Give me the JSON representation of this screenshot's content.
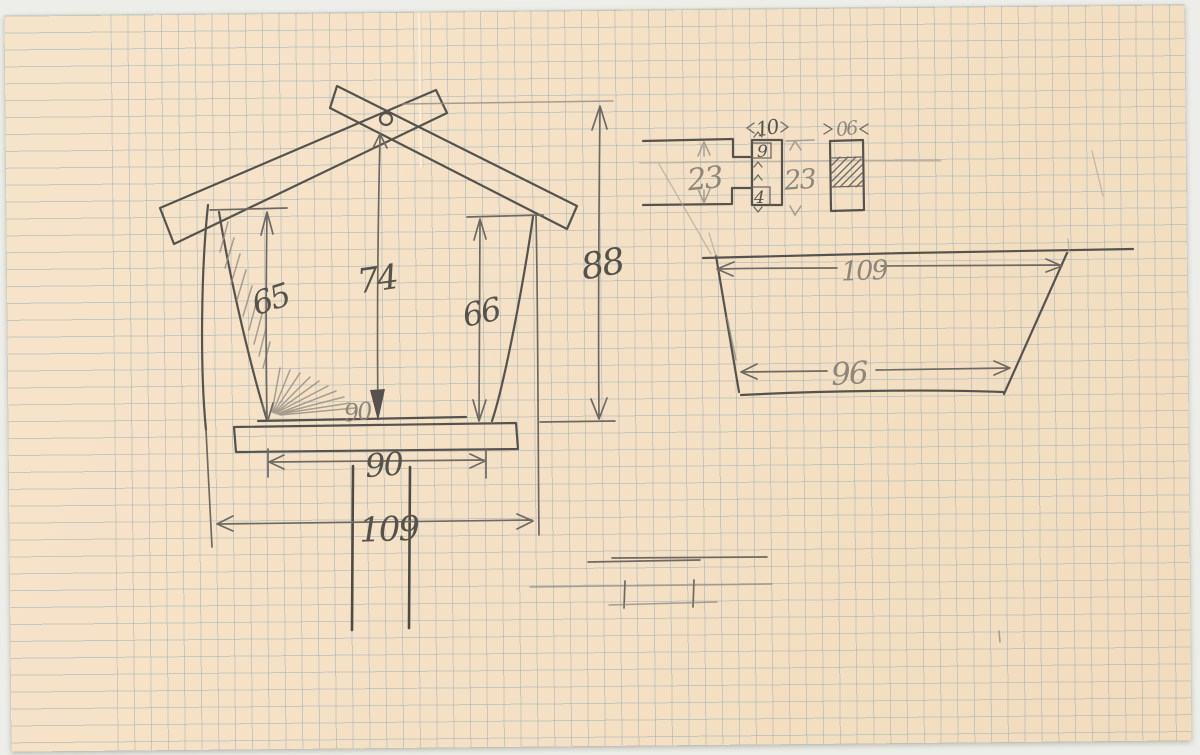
{
  "scene": {
    "paper_color": "#f4e1c6",
    "grid_color": "#7d9faf",
    "pencil_color": "#56534e",
    "background_color": "#edeee9"
  },
  "front_view": {
    "left_wall_height": "65",
    "ridge_height": "74",
    "right_wall_height": "66",
    "overall_height": "88",
    "platform_width": "90",
    "base_inner_width": "90",
    "base_overall_width": "109"
  },
  "joint_detail": {
    "slot_width": "10",
    "top_notch_depth": "9",
    "bottom_notch_depth": "4",
    "left_height": "23",
    "right_height": "23",
    "block_width": "06"
  },
  "roof_panel": {
    "top_width": "109",
    "bottom_width": "96"
  }
}
